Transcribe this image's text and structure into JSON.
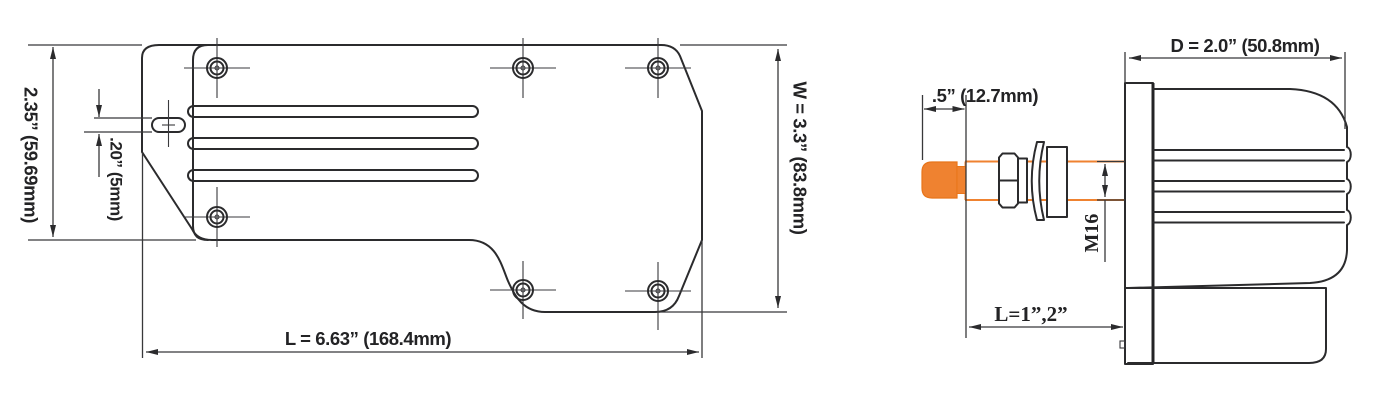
{
  "title": "Wiper motor dimension drawing",
  "views": {
    "top_view": {
      "name": "Top view",
      "dim_height": "2.35” (59.69mm)",
      "dim_slot": ".20” (5mm)",
      "dim_width": "W = 3.3” (83.8mm)",
      "dim_length": "L = 6.63” (168.4mm)"
    },
    "side_view": {
      "name": "Side view",
      "dim_tip": ".5” (12.7mm)",
      "dim_depth": "D = 2.0” (50.8mm)",
      "dim_thread": "M16",
      "dim_shaft_length": "L=1”,2”"
    }
  },
  "colors": {
    "line": "#2b2b2d",
    "accent_orange": "#EF8230",
    "background": "#ffffff"
  }
}
